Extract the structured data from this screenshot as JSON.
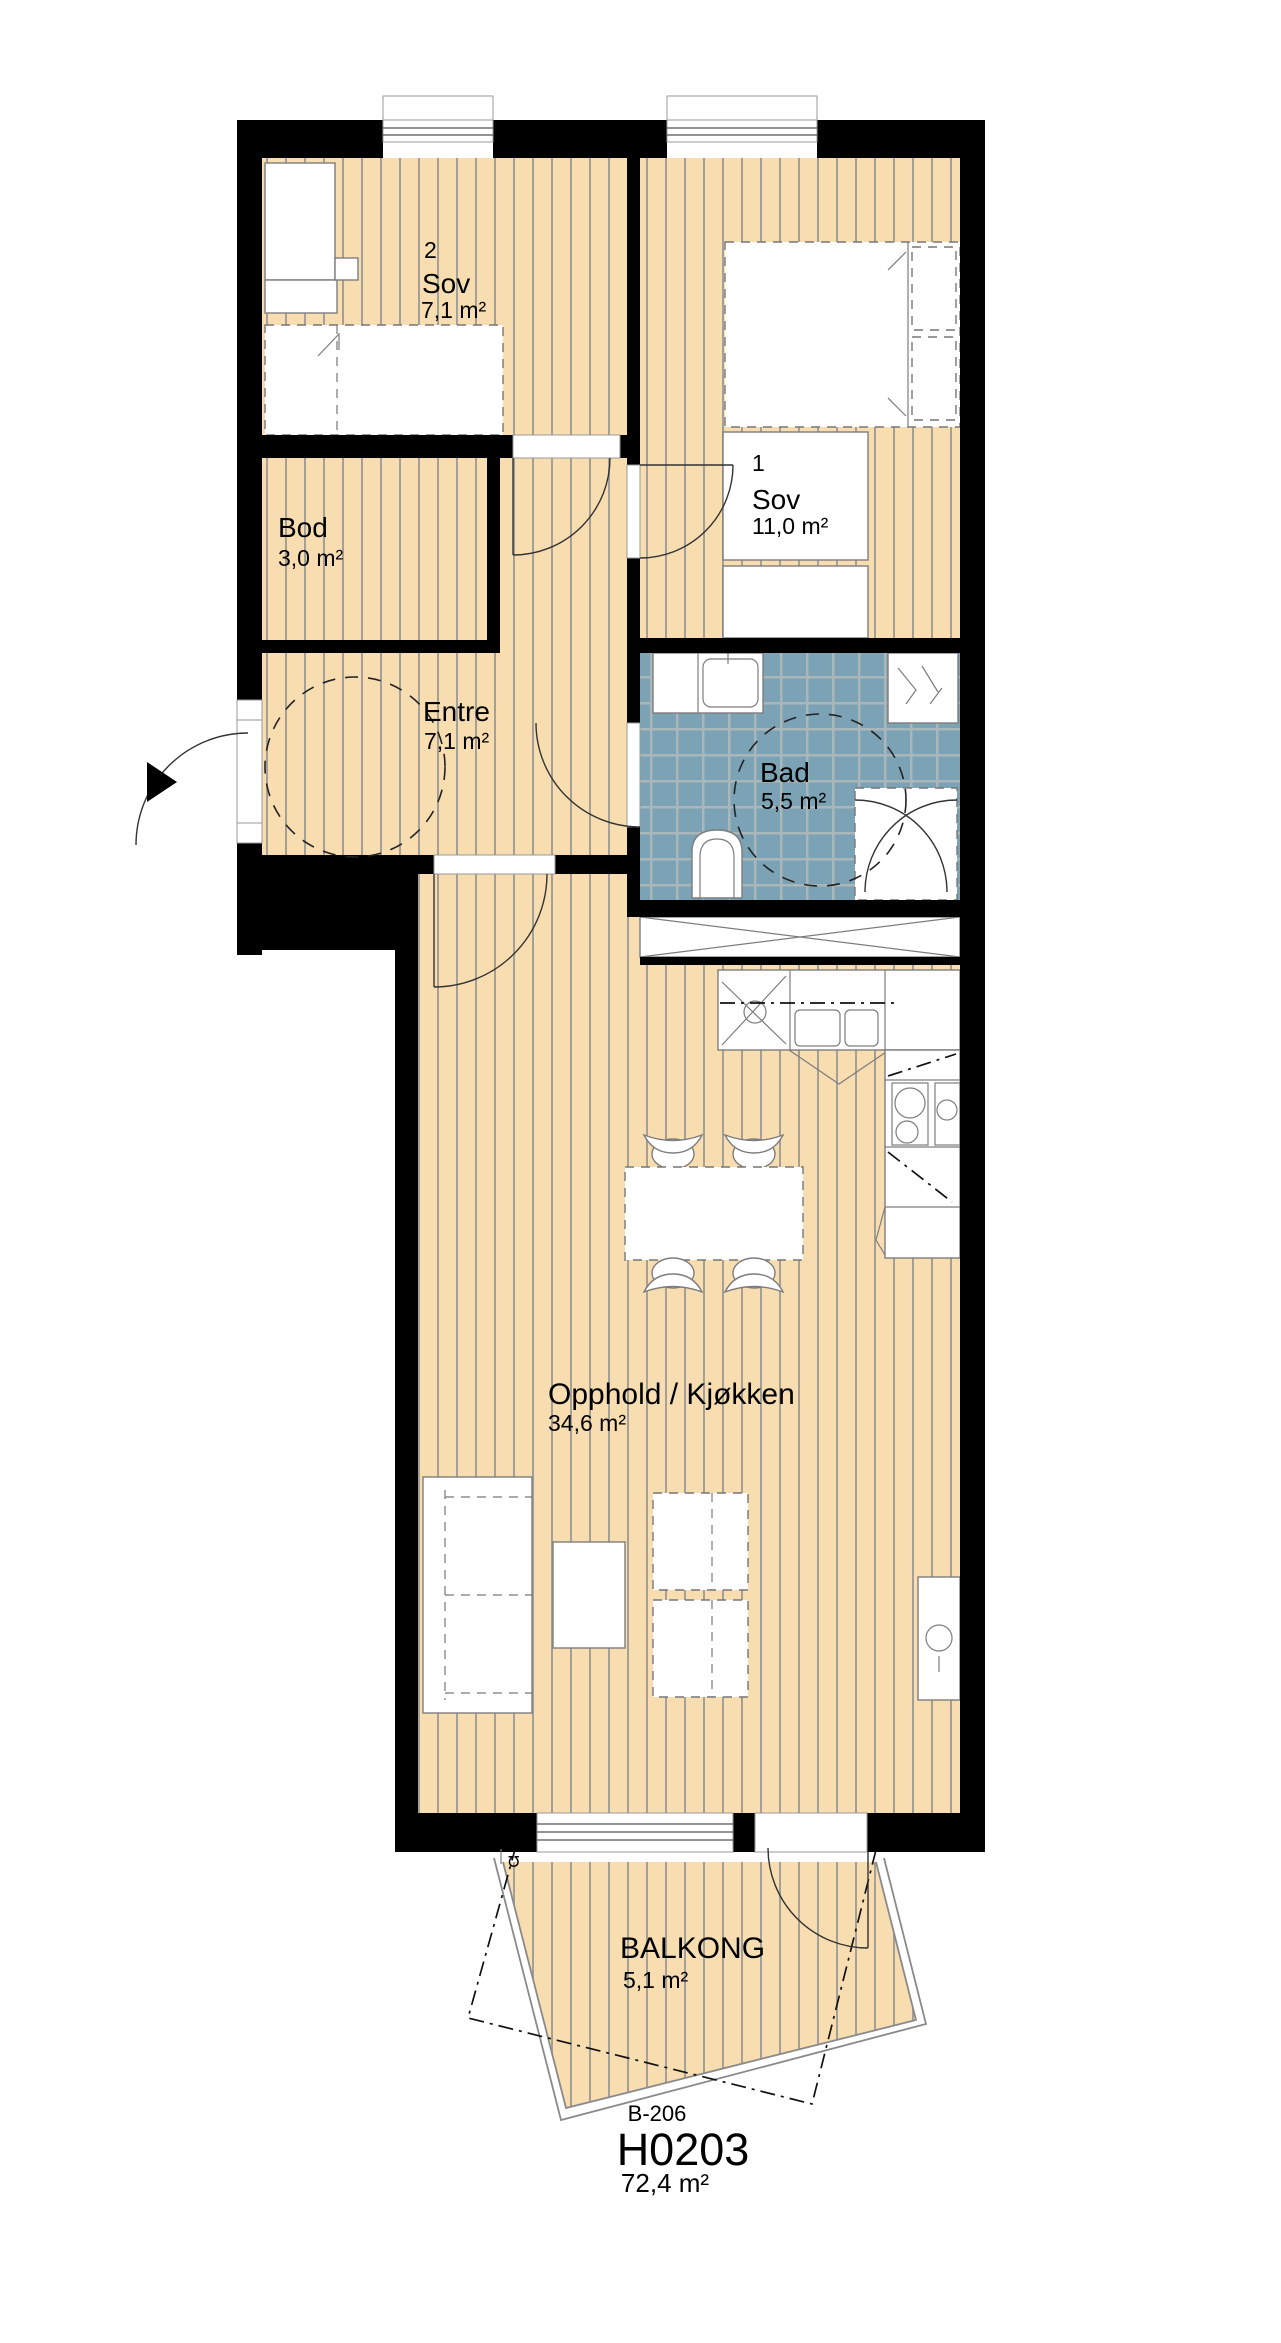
{
  "unit": {
    "building_code": "B-206",
    "unit_id": "H0203",
    "total_area": "72,4 m²"
  },
  "rooms": [
    {
      "key": "sov2",
      "number": "2",
      "name": "Sov",
      "area": "7,1 m²"
    },
    {
      "key": "sov1",
      "number": "1",
      "name": "Sov",
      "area": "11,0 m²"
    },
    {
      "key": "bod",
      "name": "Bod",
      "area": "3,0 m²"
    },
    {
      "key": "entre",
      "name": "Entre",
      "area": "7,1 m²"
    },
    {
      "key": "bad",
      "name": "Bad",
      "area": "5,5 m²"
    },
    {
      "key": "opphold",
      "name": "Opphold / Kjøkken",
      "area": "34,6 m²"
    },
    {
      "key": "balkong",
      "name": "BALKONG",
      "area": "5,1 m²"
    }
  ],
  "annotations": {
    "balcony_drain_symbol": "℧"
  },
  "colors": {
    "floor": "#f8ddb0",
    "floor_stripe": "#a49f97",
    "tile": "#7ba3b5",
    "tile_grout": "#a9b6ba",
    "wall": "#000000"
  }
}
